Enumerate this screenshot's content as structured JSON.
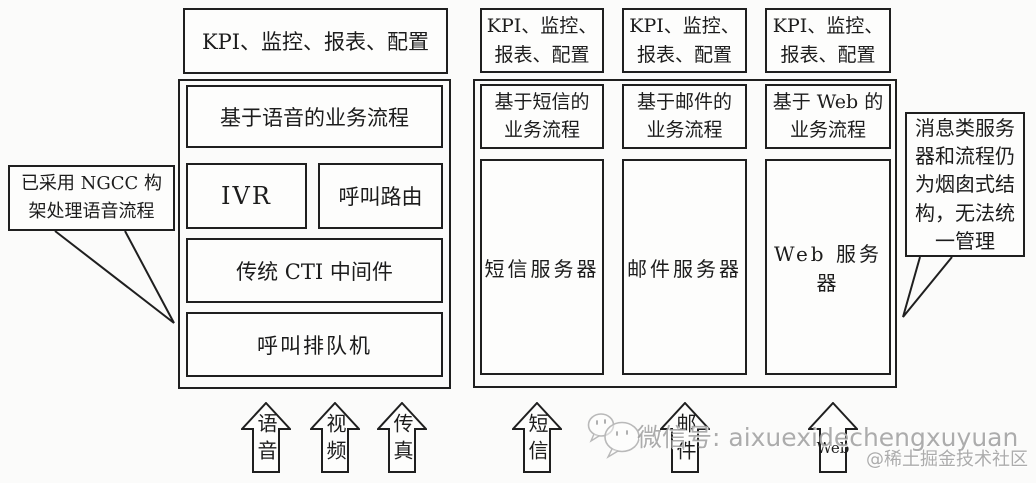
{
  "colors": {
    "line": "#1f1f1f",
    "background": "#fbfbfa",
    "watermark_gray": "#9e9e9e"
  },
  "voice_stack": {
    "kpi_label": "KPI、监控、报表、配置",
    "process_label": "基于语音的业务流程",
    "ivr_label": "IVR",
    "call_routing_label": "呼叫路由",
    "cti_label": "传统 CTI 中间件",
    "call_queue_label": "呼叫排队机"
  },
  "message_stacks": {
    "columns": [
      {
        "kpi_label": "KPI、监控、\n报表、配置",
        "process_label": "基于短信的\n业务流程",
        "server_label": "短信服务器"
      },
      {
        "kpi_label": "KPI、监控、\n报表、配置",
        "process_label": "基于邮件的\n业务流程",
        "server_label": "邮件服务器"
      },
      {
        "kpi_label": "KPI、监控、\n报表、配置",
        "process_label": "基于 Web 的\n业务流程",
        "server_label": "Web 服务器"
      }
    ]
  },
  "callouts": {
    "voice_note": "已采用 NGCC 构\n架处理语音流程",
    "message_note": "消息类服务\n器和流程仍\n为烟囱式结\n构，无法统\n一管理"
  },
  "input_channels": {
    "items": [
      {
        "label": "语音"
      },
      {
        "label": "视频"
      },
      {
        "label": "传真"
      },
      {
        "label": "短信"
      },
      {
        "label": "邮件"
      },
      {
        "label": "Web"
      }
    ]
  },
  "watermark": {
    "wechat_id": "微信号: aixuexidechengxuyuan",
    "community": "@稀土掘金技术社区"
  }
}
